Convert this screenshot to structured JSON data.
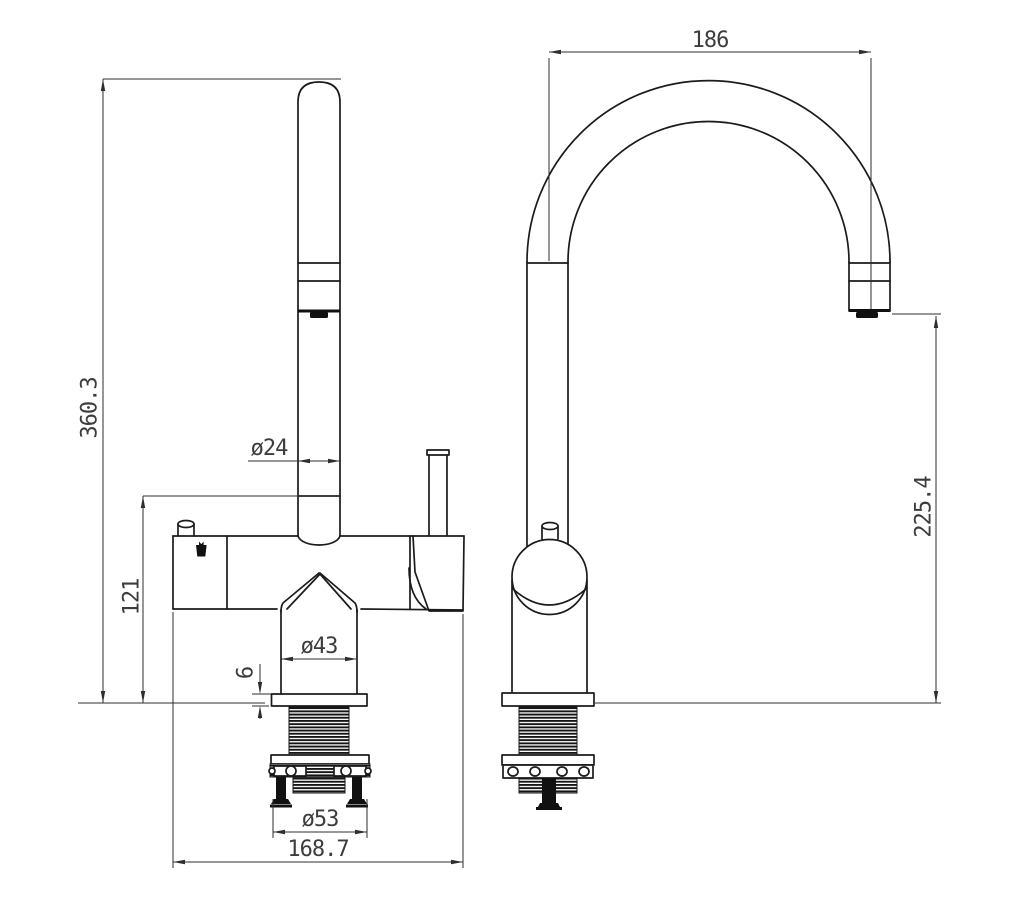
{
  "drawing": {
    "kind": "kitchen-faucet-two-view-technical-drawing",
    "views": [
      "front",
      "side"
    ]
  },
  "dims": {
    "spout_reach": "186",
    "total_height": "360.3",
    "body_height": "121",
    "tube_diameter": "ø24",
    "cone_diameter": "ø43",
    "flange_thickness": "6",
    "flange_diameter": "ø53",
    "base_depth": "168.7",
    "outlet_height": "225.4"
  },
  "colors": {
    "background": "#ffffff",
    "object_line": "#1b1b1b",
    "dimension_line": "#2e2e2e",
    "dimension_text": "#3c3c3c"
  }
}
